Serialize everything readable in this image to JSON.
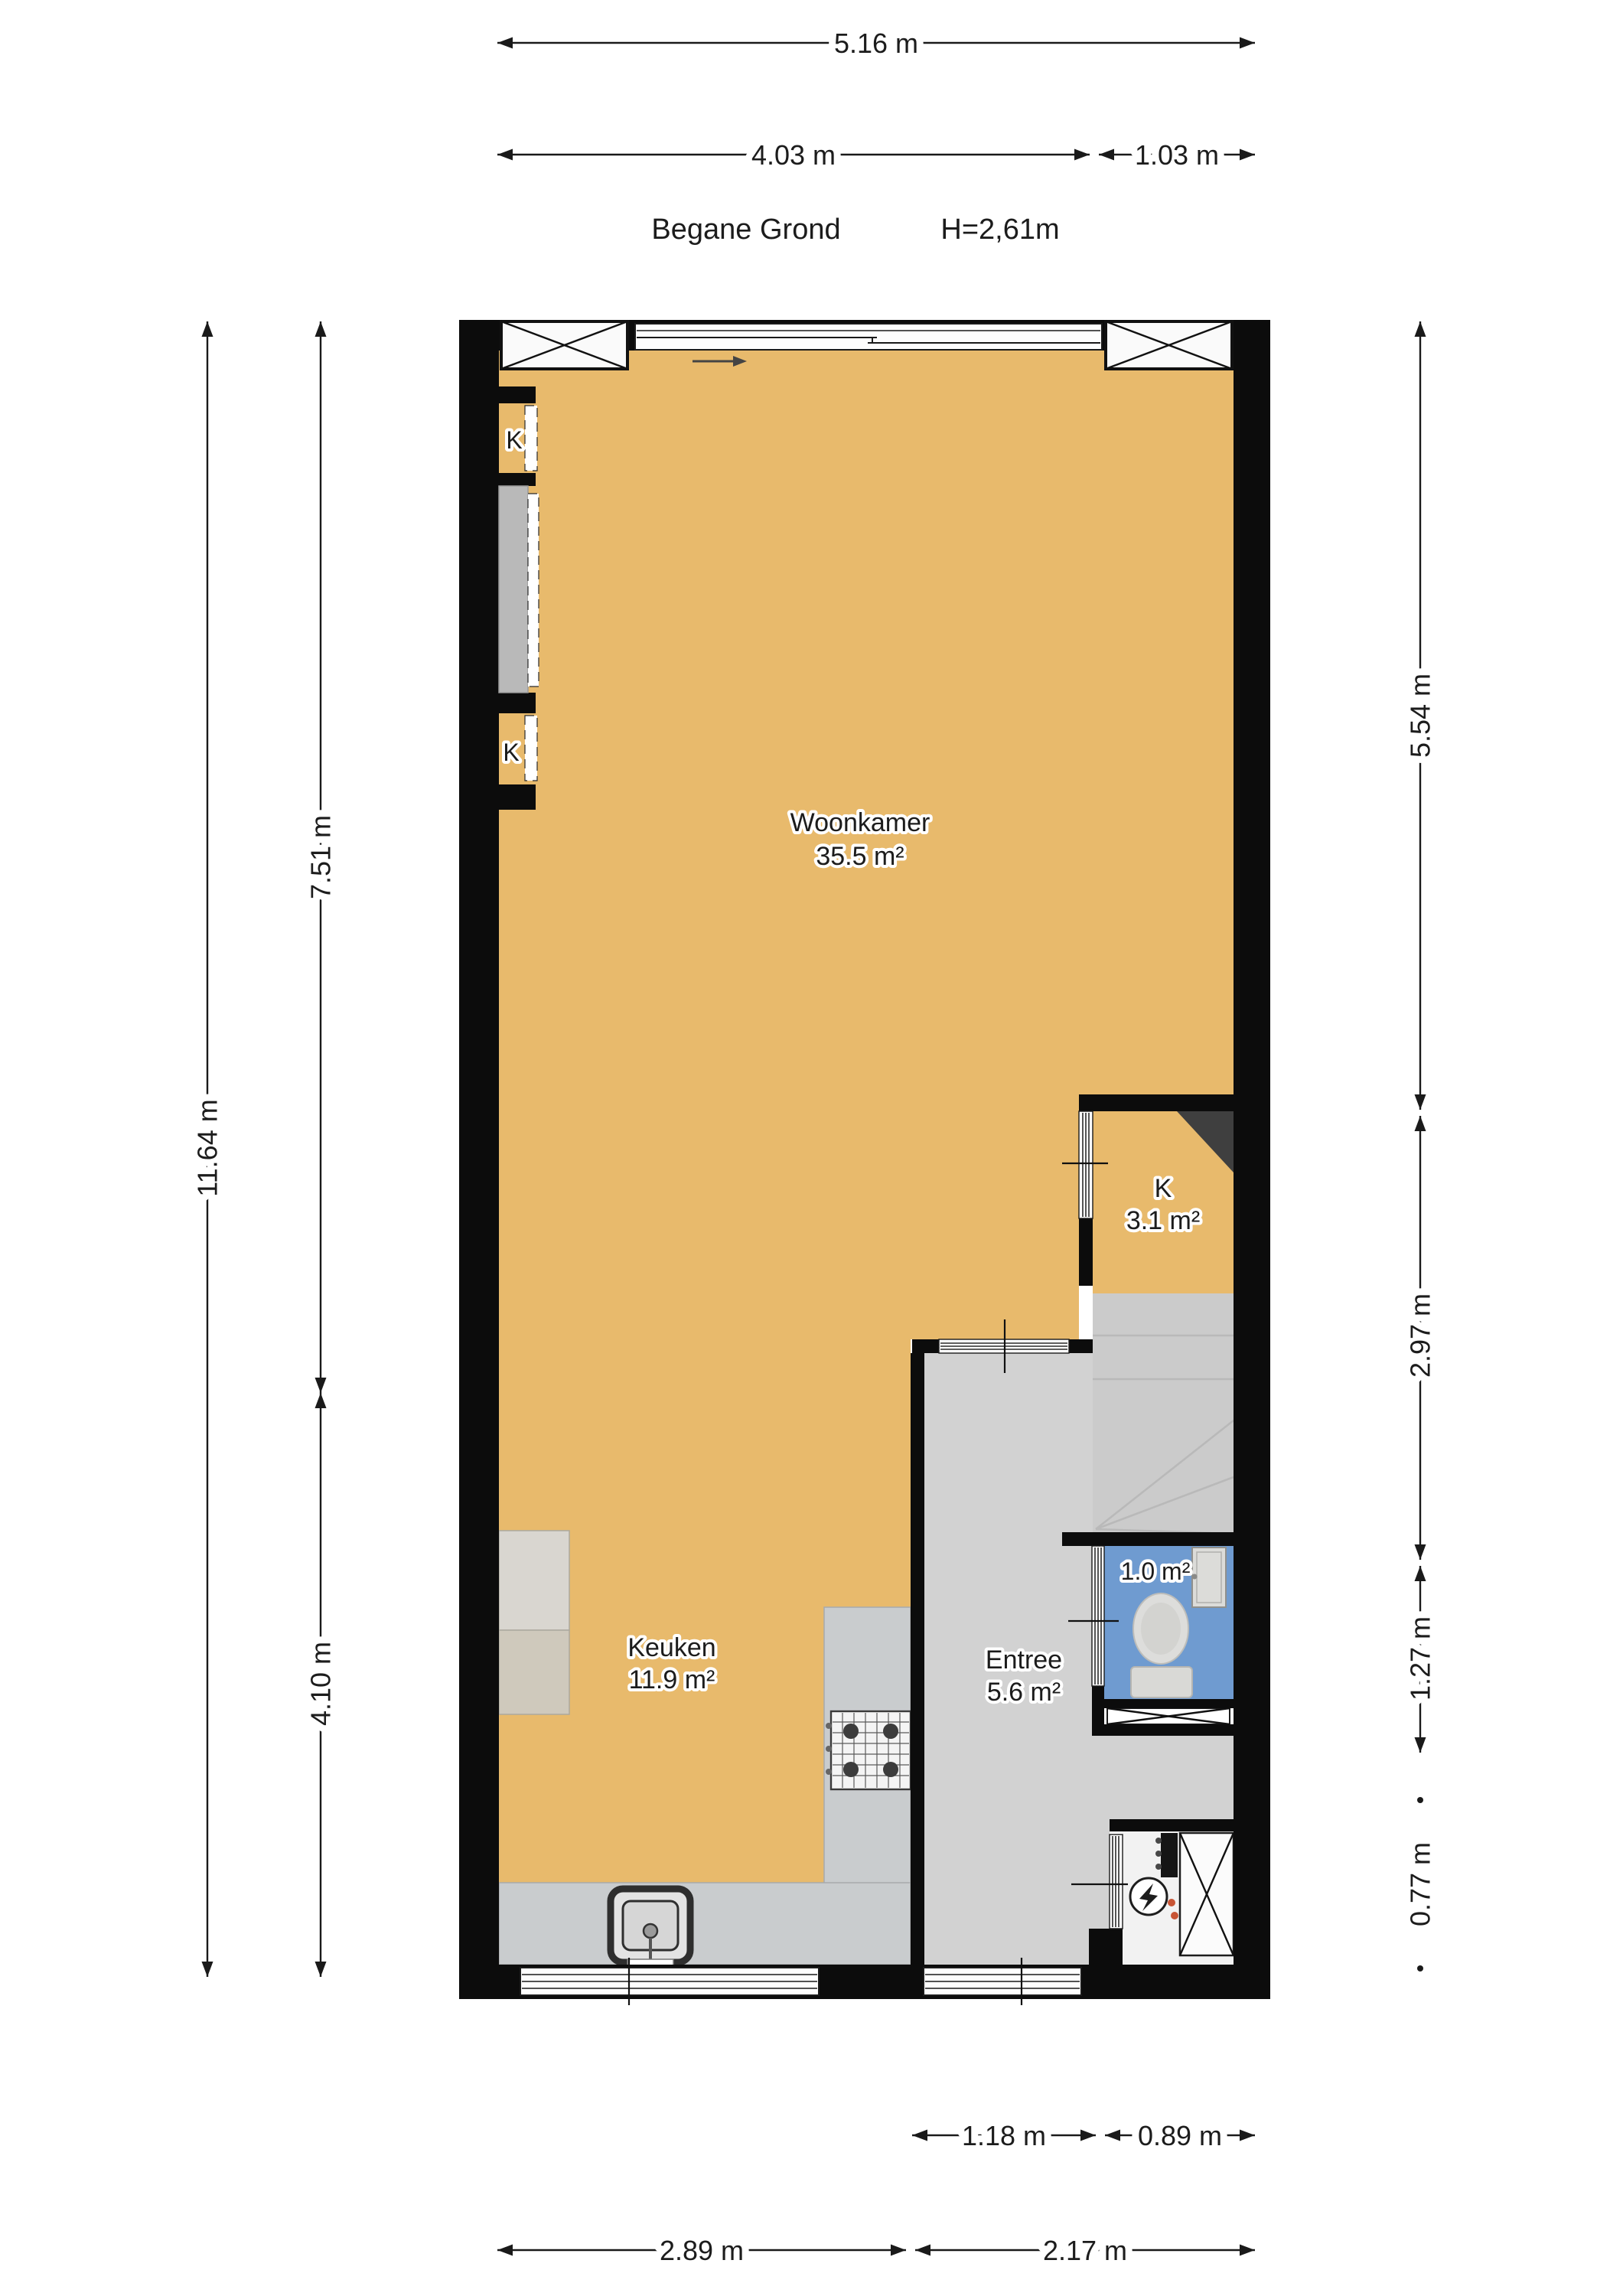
{
  "title": {
    "floor_label": "Begane Grond",
    "ceiling_height": "H=2,61m"
  },
  "rooms": {
    "woonkamer": {
      "name": "Woonkamer",
      "area": "35.5 m²"
    },
    "keuken": {
      "name": "Keuken",
      "area": "11.9 m²"
    },
    "entree": {
      "name": "Entree",
      "area": "5.6 m²"
    },
    "kast_room": {
      "name": "K",
      "area": "3.1 m²"
    },
    "toilet": {
      "area": "1.0 m²"
    },
    "closet_label": "K"
  },
  "dimensions": {
    "top": [
      "5.16 m",
      "4.03 m",
      "1.03 m"
    ],
    "left": [
      "11.64 m",
      "7.51 m",
      "4.10 m"
    ],
    "right": [
      "5.54 m",
      "2.97 m",
      "1.27 m",
      "0.77 m"
    ],
    "bottom": [
      "1.18 m",
      "0.89 m",
      "2.89 m",
      "2.17 m"
    ]
  },
  "colors": {
    "floor_living": "#e8ba6c",
    "floor_hall": "#d2d2d2",
    "floor_stairs": "#cbcbcb",
    "floor_toilet": "#6f9bd0",
    "wall": "#0c0c0c",
    "counter": "#c9ccce",
    "closet_gray": "#b9b9b9",
    "flue": "#3f3f3f",
    "meter_accent": "#c85535"
  }
}
